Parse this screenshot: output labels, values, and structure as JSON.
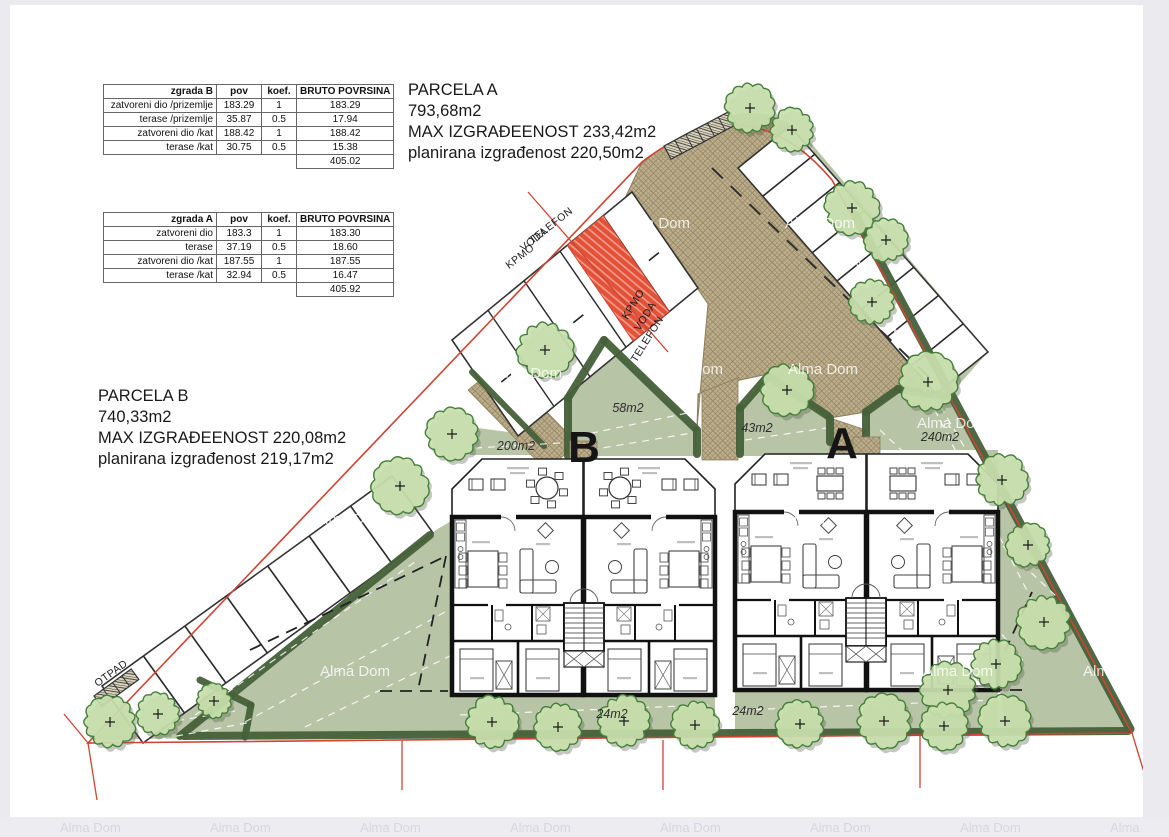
{
  "colors": {
    "garden_green": "#b7c4a6",
    "hedge_green": "#46603a",
    "tree_green": "#c9dfae",
    "tree_outline": "#45803a",
    "driveway_brown": "#bcae90",
    "boundary_red": "#cf4433",
    "utility_strip_red": "#e25138",
    "wall_black": "#111111",
    "page_edge_gray": "#ebebef"
  },
  "tables": [
    {
      "name": "zgrada-b-table",
      "header": [
        "zgrada B",
        "pov",
        "koef.",
        "BRUTO POVRSINA"
      ],
      "rows": [
        [
          "zatvoreni dio /prizemlje",
          "183.29",
          "1",
          "183.29"
        ],
        [
          "terase /prizemlje",
          "35.87",
          "0.5",
          "17.94"
        ],
        [
          "zatvoreni dio /kat",
          "188.42",
          "1",
          "188.42"
        ],
        [
          "terase /kat",
          "30.75",
          "0.5",
          "15.38"
        ]
      ],
      "total": "405.02"
    },
    {
      "name": "zgrada-a-table",
      "header": [
        "zgrada A",
        "pov",
        "koef.",
        "BRUTO POVRSINA"
      ],
      "rows": [
        [
          "zatvoreni dio",
          "183.3",
          "1",
          "183.30"
        ],
        [
          "terase",
          "37.19",
          "0.5",
          "18.60"
        ],
        [
          "zatvoreni dio /kat",
          "187.55",
          "1",
          "187.55"
        ],
        [
          "terase /kat",
          "32.94",
          "0.5",
          "16.47"
        ]
      ],
      "total": "405.92"
    }
  ],
  "parcela_a": {
    "lines": [
      "PARCELA A",
      "793,68m2",
      "MAX IZGRAĐEENOST 233,42m2",
      "planirana izgrađenost 220,50m2"
    ]
  },
  "parcela_b": {
    "lines": [
      "PARCELA B",
      "740,33m2",
      "MAX IZGRAĐEENOST 220,08m2",
      "planirana izgrađenost 219,17m2"
    ]
  },
  "site": {
    "building_labels": [
      {
        "text": "B"
      },
      {
        "text": "A"
      }
    ],
    "area_labels": [
      {
        "text": "58m2"
      },
      {
        "text": "43m2"
      },
      {
        "text": "200m2"
      },
      {
        "text": "240m2"
      },
      {
        "text": "24m2"
      },
      {
        "text": "24m2"
      }
    ],
    "utility_labels_upper": [
      "TELEFON",
      "VODA",
      "KPMO"
    ],
    "utility_labels_lower": [
      "KPMO",
      "VODA",
      "TELEFON"
    ],
    "otpad_label": "OTPAD",
    "watermark": "Alma Dom"
  }
}
